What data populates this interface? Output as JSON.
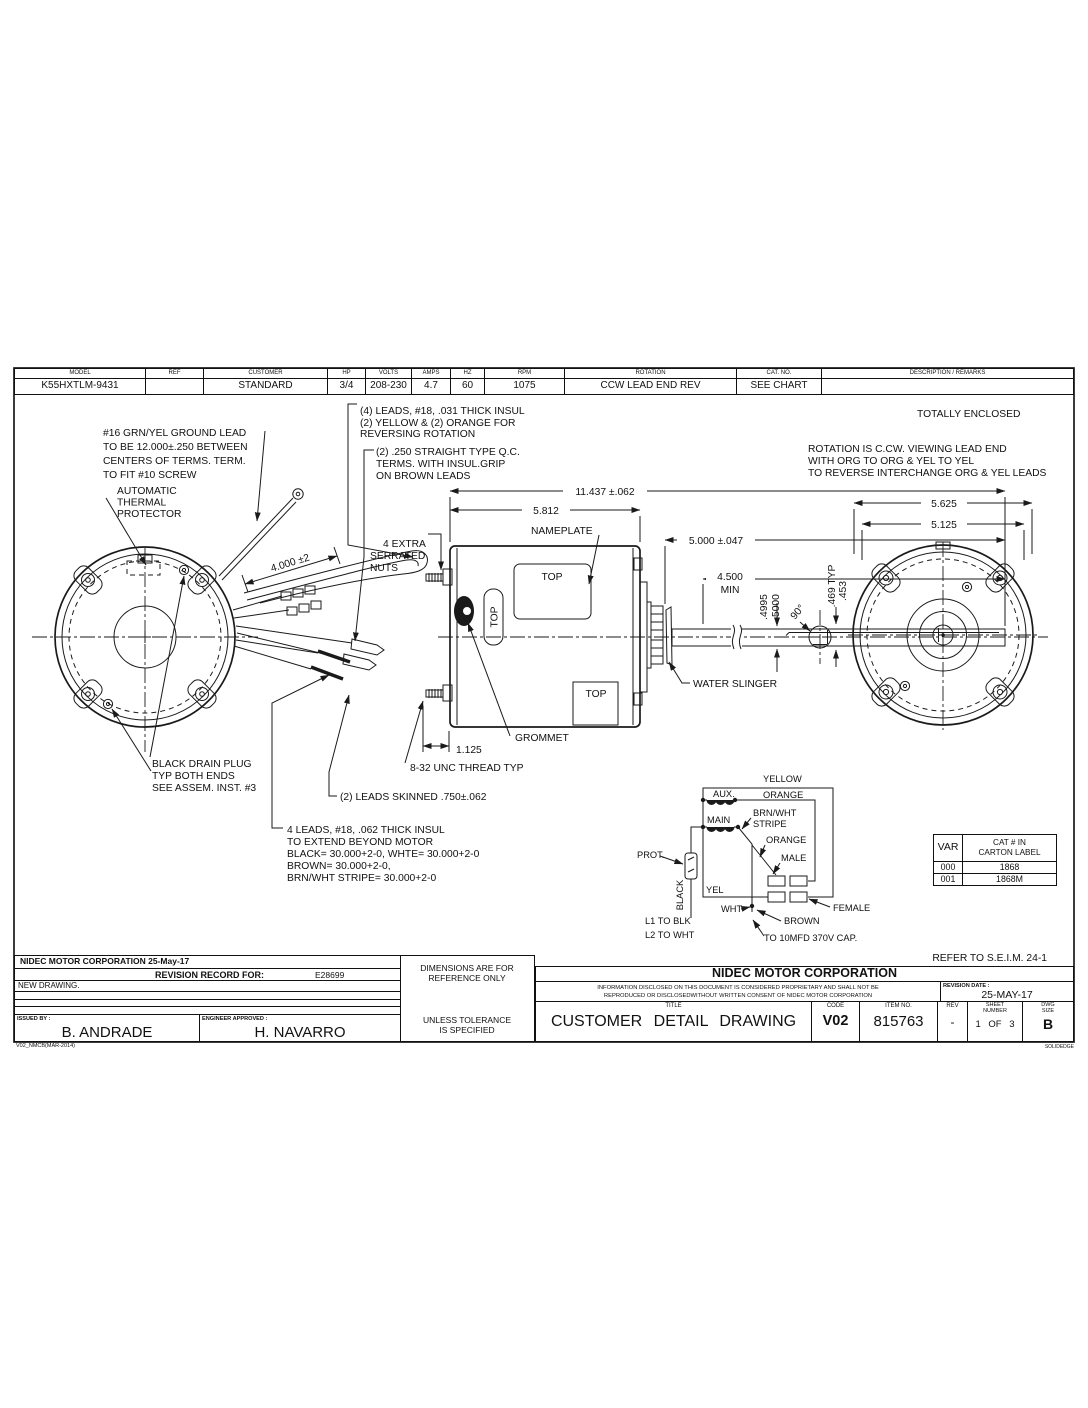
{
  "header_table": {
    "columns": [
      {
        "label": "MODEL",
        "value": "K55HXTLM-9431"
      },
      {
        "label": "REF",
        "value": ""
      },
      {
        "label": "CUSTOMER",
        "value": "STANDARD"
      },
      {
        "label": "HP",
        "value": "3/4"
      },
      {
        "label": "VOLTS",
        "value": "208-230"
      },
      {
        "label": "AMPS",
        "value": "4.7"
      },
      {
        "label": "HZ",
        "value": "60"
      },
      {
        "label": "RPM",
        "value": "1075"
      },
      {
        "label": "ROTATION",
        "value": "CCW LEAD END REV"
      },
      {
        "label": "CAT. NO.",
        "value": "SEE CHART"
      },
      {
        "label": "DESCRIPTION / REMARKS",
        "value": ""
      }
    ]
  },
  "notes": {
    "ground_lead": [
      "#16 GRN/YEL GROUND LEAD",
      "TO BE 12.000±.250 BETWEEN",
      "CENTERS OF TERMS. TERM.",
      "TO FIT #10 SCREW"
    ],
    "thermal": [
      "AUTOMATIC",
      "THERMAL",
      "PROTECTOR"
    ],
    "leads4_top": [
      "(4) LEADS, #18, .031 THICK INSUL",
      "(2) YELLOW & (2) ORANGE FOR",
      "REVERSING ROTATION"
    ],
    "qc_terms": [
      "(2) .250 STRAIGHT TYPE Q.C.",
      "TERMS. WITH INSUL.GRIP",
      "ON BROWN LEADS"
    ],
    "serrated": [
      "4 EXTRA",
      "SERRATED",
      "NUTS"
    ],
    "totally_enclosed": "TOTALLY ENCLOSED",
    "rotation": [
      "ROTATION IS C.CW. VIEWING LEAD END",
      "WITH ORG TO ORG & YEL TO YEL",
      "TO REVERSE INTERCHANGE ORG & YEL LEADS"
    ],
    "drain_plug": [
      "BLACK DRAIN PLUG",
      "TYP BOTH ENDS",
      "SEE ASSEM. INST. #3"
    ],
    "leads4_bottom": [
      "4 LEADS, #18, .062 THICK INSUL",
      "TO EXTEND BEYOND MOTOR",
      "BLACK= 30.000+2-0, WHTE= 30.000+2-0",
      "BROWN= 30.000+2-0,",
      "BRN/WHT STRIPE= 30.000+2-0"
    ],
    "leads_skinned": "(2) LEADS SKINNED .750±.062",
    "thread": "8-32 UNC THREAD TYP",
    "nameplate": "NAMEPLATE",
    "grommet": "GROMMET",
    "water_slinger": "WATER SLINGER",
    "top": "TOP",
    "refer": "REFER TO S.E.I.M. 24-1"
  },
  "dims": {
    "overall": "11.437 ±.062",
    "body": "5.812",
    "shaft_ext": "5.000 ±.047",
    "shaft_min": "4.500",
    "min": "MIN",
    "dia_hi": ".4995",
    "dia_lo": ".5000",
    "angle": "90°",
    "flat1": ".469  TYP",
    "flat2": ".453",
    "stud": "1.125",
    "lead_len": "4.000 ±2",
    "dia_outer": "5.625",
    "dia_inner": "5.125"
  },
  "schematic": {
    "yellow": "YELLOW",
    "aux": "AUX.",
    "orange_top": "ORANGE",
    "main": "MAIN",
    "brnwht1": "BRN/WHT",
    "brnwht2": "STRIPE",
    "orange_mid": "ORANGE",
    "male": "MALE",
    "prot": "PROT.",
    "black": "BLACK",
    "yel": "YEL",
    "wht": "WHT",
    "female": "FEMALE",
    "brown": "BROWN",
    "l1": "L1 TO BLK",
    "l2": "L2 TO WHT",
    "cap": "TO 10MFD 370V CAP."
  },
  "var_table": {
    "col1": "VAR",
    "col2a": "CAT # IN",
    "col2b": "CARTON LABEL",
    "rows": [
      [
        "000",
        "1868"
      ],
      [
        "001",
        "1868M"
      ]
    ]
  },
  "title_block": {
    "company_date": "NIDEC MOTOR CORPORATION 25-May-17",
    "revision_record": "REVISION RECORD FOR:",
    "revision_number": "E28699",
    "new_drawing": "NEW DRAWING.",
    "issued_by_label": "ISSUED BY :",
    "issued_by": "B. ANDRADE",
    "engineer_label": "ENGINEER APPROVED :",
    "engineer": "H. NAVARRO",
    "dim_note1": "DIMENSIONS ARE FOR",
    "dim_note2": "REFERENCE ONLY",
    "tol_note1": "UNLESS TOLERANCE",
    "tol_note2": "IS SPECIFIED",
    "company": "NIDEC MOTOR CORPORATION",
    "legal1": "INFORMATION DISCLOSED ON THIS DOCUMENT IS CONSIDERED PROPRIETARY AND SHALL NOT BE",
    "legal2": "REPRODUCED OR DISCLOSEDWITHOUT WRITTEN CONSENT OF NIDEC MOTOR CORPORATION",
    "revision_date_label": "REVISION DATE :",
    "revision_date": "25-MAY-17",
    "title_label": "TITLE",
    "title": "CUSTOMER DETAIL DRAWING",
    "code_label": "CODE",
    "code": "V02",
    "item_label": "ITEM NO.",
    "item": "815763",
    "rev_label": "REV",
    "rev": "-",
    "sheet_label1": "SHEET",
    "sheet_label2": "NUMBER",
    "sheet": "1 OF 3",
    "size_label1": "DWG",
    "size_label2": "SIZE",
    "size": "B",
    "form_code": "V02_NMCB(MAR-2014)",
    "solidedge": "SOLIDEDGE"
  }
}
